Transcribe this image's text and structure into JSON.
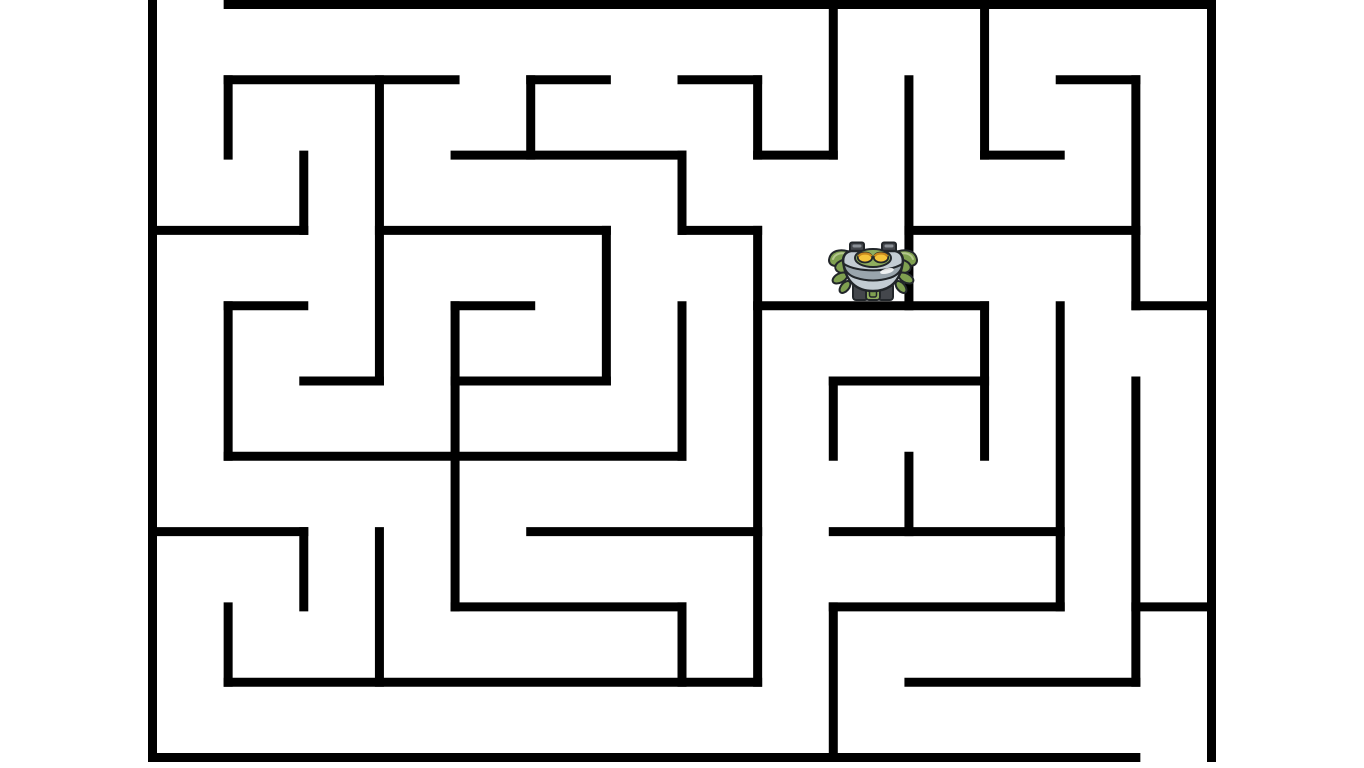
{
  "page": {
    "background_color": "#ffffff",
    "width": 1364,
    "height": 768
  },
  "maze": {
    "wall_color": "#000000",
    "wall_thickness": 9,
    "origin_x": 148,
    "origin_y": 0,
    "width": 1068,
    "height": 762,
    "cols": 14,
    "rows": 10,
    "entrance": {
      "col": 0,
      "row": 0,
      "side": "top"
    },
    "exit": {
      "col": 13,
      "row": 9,
      "side": "bottom"
    },
    "h_walls_format": "[row_line, from_col, to_col]",
    "h_walls": [
      [
        0,
        1,
        14
      ],
      [
        1,
        1,
        4
      ],
      [
        1,
        5,
        6
      ],
      [
        1,
        7,
        8
      ],
      [
        1,
        12,
        13
      ],
      [
        2,
        4,
        7
      ],
      [
        2,
        8,
        9
      ],
      [
        2,
        11,
        12
      ],
      [
        3,
        0,
        2
      ],
      [
        3,
        3,
        6
      ],
      [
        3,
        7,
        8
      ],
      [
        3,
        10,
        13
      ],
      [
        4,
        1,
        2
      ],
      [
        4,
        4,
        5
      ],
      [
        4,
        8,
        11
      ],
      [
        4,
        13,
        14
      ],
      [
        5,
        2,
        3
      ],
      [
        5,
        4,
        6
      ],
      [
        5,
        9,
        11
      ],
      [
        6,
        1,
        7
      ],
      [
        7,
        0,
        2
      ],
      [
        7,
        5,
        8
      ],
      [
        7,
        9,
        12
      ],
      [
        8,
        4,
        7
      ],
      [
        8,
        9,
        12
      ],
      [
        8,
        13,
        14
      ],
      [
        9,
        1,
        8
      ],
      [
        9,
        10,
        13
      ],
      [
        10,
        0,
        13
      ]
    ],
    "v_walls_format": "[col_line, from_row, to_row]",
    "v_walls": [
      [
        0,
        0,
        10
      ],
      [
        1,
        1,
        2
      ],
      [
        1,
        4,
        6
      ],
      [
        1,
        8,
        9
      ],
      [
        2,
        2,
        3
      ],
      [
        2,
        7,
        8
      ],
      [
        3,
        1,
        5
      ],
      [
        3,
        7,
        9
      ],
      [
        4,
        4,
        8
      ],
      [
        5,
        1,
        2
      ],
      [
        6,
        3,
        5
      ],
      [
        7,
        2,
        3
      ],
      [
        7,
        4,
        6
      ],
      [
        7,
        8,
        9
      ],
      [
        8,
        1,
        2
      ],
      [
        8,
        3,
        9
      ],
      [
        9,
        0,
        2
      ],
      [
        9,
        5,
        6
      ],
      [
        9,
        8,
        10
      ],
      [
        10,
        1,
        4
      ],
      [
        10,
        6,
        7
      ],
      [
        11,
        0,
        2
      ],
      [
        11,
        4,
        6
      ],
      [
        12,
        4,
        8
      ],
      [
        13,
        1,
        4
      ],
      [
        13,
        5,
        9
      ],
      [
        14,
        0,
        10
      ]
    ]
  },
  "player": {
    "name": "crab-robot",
    "cell": {
      "col": 9,
      "row": 3
    },
    "x": 827,
    "y": 241,
    "width": 92,
    "height": 62,
    "colors": {
      "claw": "#7fa050",
      "claw_light": "#b5c78e",
      "head": "#8fae5e",
      "body": "#c3ccd3",
      "rim": "#9aa5ad",
      "shadow": "#5e6a52",
      "eye": "#f4c43b",
      "eye_ring": "#c98a1e",
      "tread": "#44474c",
      "tread_light": "#8a8f96",
      "outline": "#22262a"
    }
  }
}
